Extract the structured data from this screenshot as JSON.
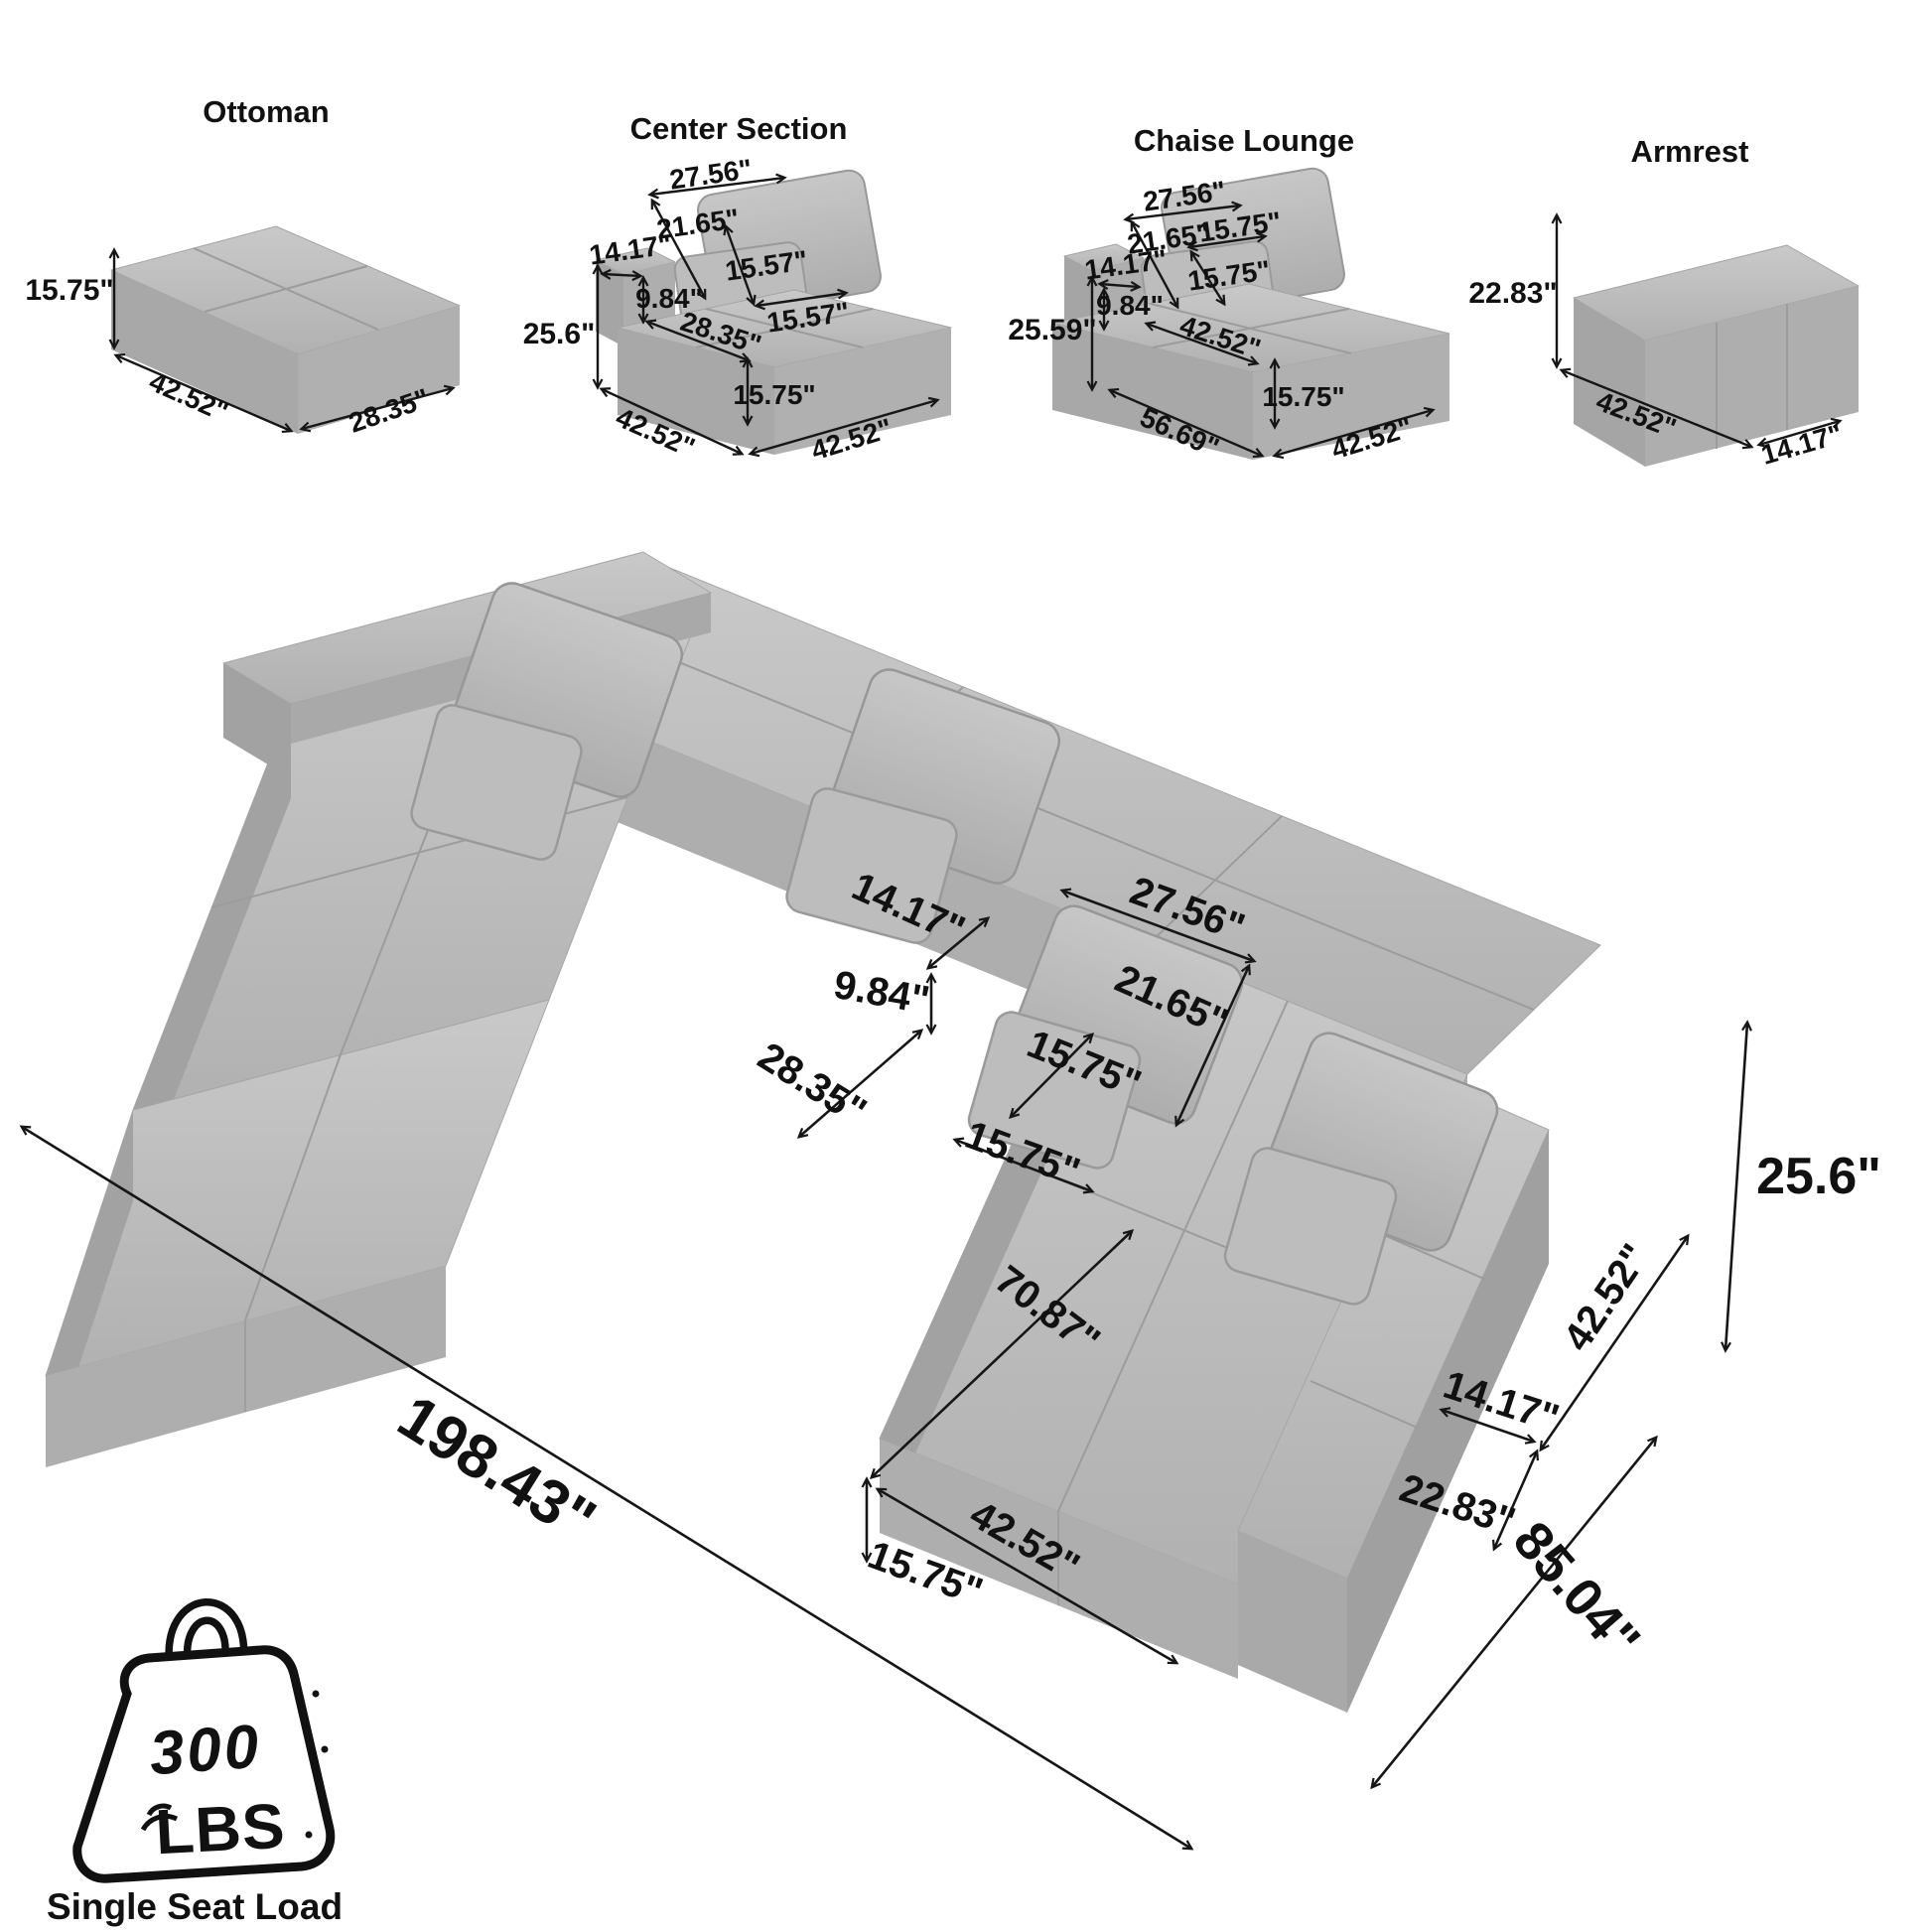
{
  "colors": {
    "sofa_gray": "#b5b5b5",
    "line": "#161616",
    "background": "#ffffff"
  },
  "modules": {
    "ottoman": {
      "title": "Ottoman",
      "height": "15.75\"",
      "width": "42.52\"",
      "depth": "28.35\""
    },
    "center_section": {
      "title": "Center Section",
      "pillow_width": "27.56\"",
      "pillow_height": "21.65\"",
      "small_pillow_height": "15.57\"",
      "small_pillow_width": "15.57\"",
      "back_depth": "14.17\"",
      "back_height": "9.84\"",
      "overall_height": "25.6\"",
      "seat_depth": "28.35\"",
      "seat_height": "15.75\"",
      "width": "42.52\"",
      "depth": "42.52\""
    },
    "chaise_lounge": {
      "title": "Chaise Lounge",
      "pillow_width": "27.56\"",
      "pillow_height": "21.65\"",
      "small_pillow_height": "15.75\"",
      "small_pillow_width": "15.75\"",
      "back_depth": "14.17\"",
      "back_height": "9.84\"",
      "overall_height": "25.59\"",
      "seat_depth": "42.52\"",
      "seat_height": "15.75\"",
      "width": "56.69\"",
      "depth": "42.52\""
    },
    "armrest": {
      "title": "Armrest",
      "height": "22.83\"",
      "width": "42.52\"",
      "depth": "14.17\""
    }
  },
  "main_view": {
    "back_depth": "14.17\"",
    "back_height": "9.84\"",
    "seat_depth": "28.35\"",
    "pillow_width": "27.56\"",
    "pillow_height": "21.65\"",
    "small_pillow_height": "15.75\"",
    "small_pillow_width": "15.75\"",
    "chaise_length": "70.87\"",
    "chaise_width": "42.52\"",
    "chaise_height": "15.75\"",
    "armrest_length": "42.52\"",
    "armrest_width": "14.17\"",
    "armrest_height": "22.83\"",
    "overall_length": "198.43\"",
    "overall_depth": "85.04\"",
    "overall_height": "25.6\""
  },
  "load_badge": {
    "value": "300",
    "unit": "LBS",
    "caption": "Single Seat Load"
  }
}
